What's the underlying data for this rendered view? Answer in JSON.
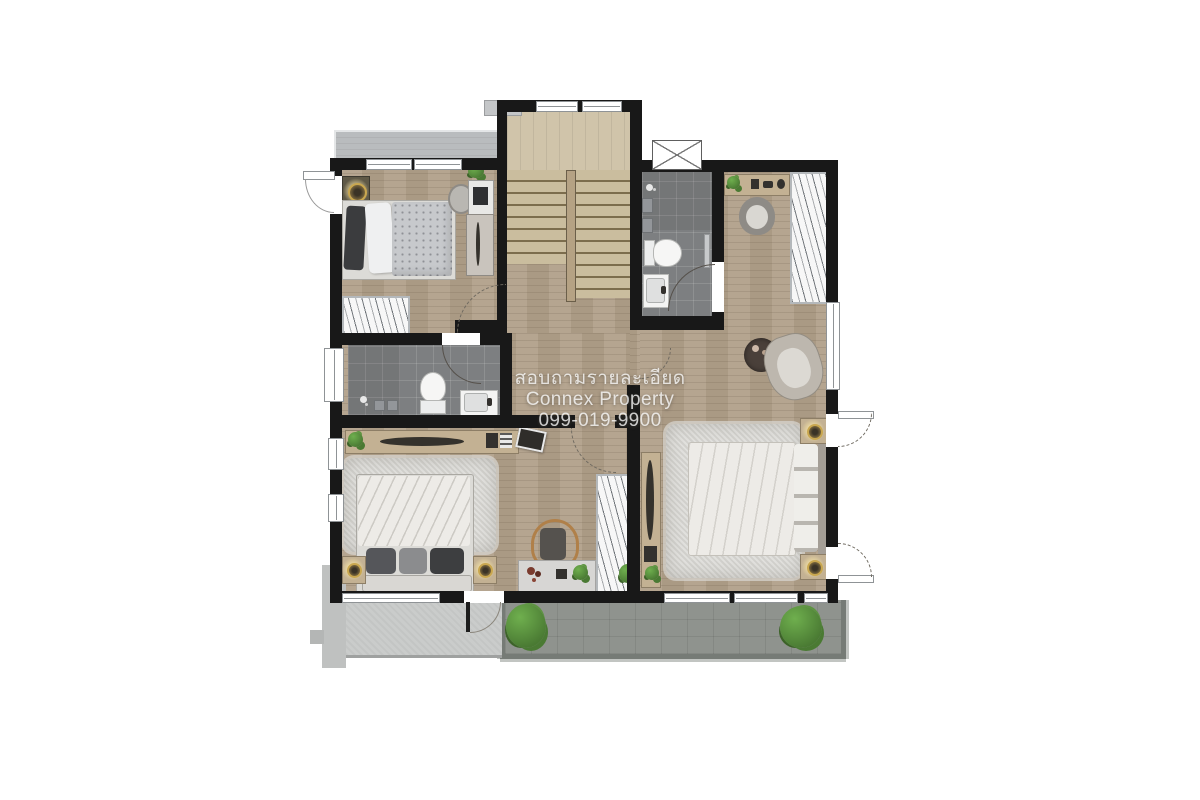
{
  "watermark": {
    "line1": "สอบถามรายละเอียด",
    "line2": "Connex Property",
    "line3": "099-019-9900"
  },
  "palette": {
    "canvas_bg": "#ffffff",
    "wall": "#181818",
    "wood_floor": "#b1a08a",
    "stair_wood": "#d0c4aa",
    "tread_line": "#7c6d4d",
    "rail_wood": "#b5a284",
    "tile": "#7d7f81",
    "balcony_floor": "#8f938e",
    "balcony_rail": "#767b76",
    "roof": "#cacccb",
    "awning": "#b9bcbe",
    "window_fill": "#ffffff",
    "window_line": "#8f9396",
    "rug": "#d8d7d3",
    "bedding_white": "#edebe7",
    "bedding_grey": "#c7c9cc",
    "pillow_dark": "#3b3c3e",
    "furniture_tan": "#c3b193",
    "furniture_dark": "#33312e",
    "wardrobe_fill": "#f7f7f7",
    "plant_green": "#4a7a33",
    "plant_green_light": "#6faf4e",
    "lamp_gold": "#c9a74f",
    "chair_wood": "#b08049",
    "seat_dark": "#55524e",
    "armchair": "#bdb7ae",
    "side_table_dark": "#4a403a",
    "watermark_color": "rgba(252,252,252,0.78)"
  },
  "icons": {
    "features": [
      "bed",
      "pillow",
      "rug",
      "nightstand",
      "table-lamp",
      "wardrobe-hangers",
      "desk",
      "laptop",
      "chair",
      "potted-plant",
      "toilet",
      "sink",
      "shower-head",
      "towel-bar",
      "armchair",
      "side-table",
      "staircase",
      "balcony",
      "roof-awning",
      "door-swing",
      "window"
    ]
  }
}
